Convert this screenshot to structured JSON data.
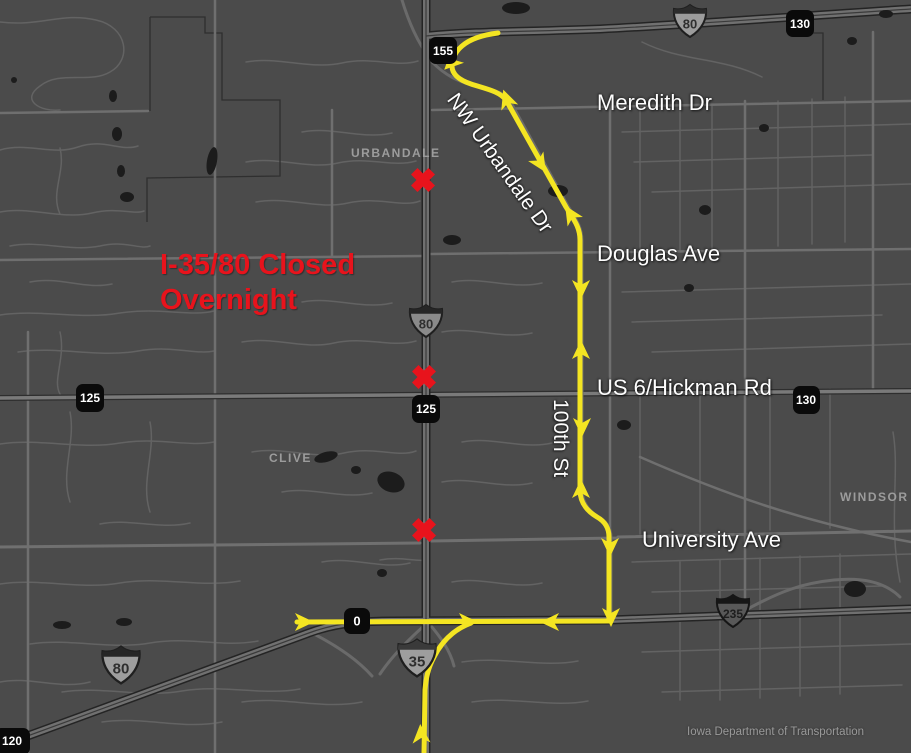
{
  "map": {
    "warning_text": "I-35/80 Closed Overnight",
    "street_labels": {
      "meredith": "Meredith Dr",
      "urbandale_dr": "NW Urbandale Dr",
      "douglas": "Douglas Ave",
      "hickman": "US 6/Hickman Rd",
      "street_100th": "100th St",
      "university": "University Ave"
    },
    "city_labels": {
      "urbandale": "URBANDALE",
      "clive": "CLIVE",
      "windsor_heights": "WINDSOR H"
    },
    "interstate_shields": {
      "i80_top": "80",
      "i80_mid": "80",
      "i80_southwest": "80",
      "i35": "35",
      "i235": "235"
    },
    "mile_markers": {
      "m155": "155",
      "m130_top": "130",
      "m125_left": "125",
      "m125_mid": "125",
      "m130_right": "130",
      "m0": "0",
      "m120": "120"
    },
    "closure_x_count": 3,
    "attribution": "Iowa Department of Transportation",
    "colors": {
      "detour_route": "#f4e522",
      "closure_red": "#e8131c",
      "background": "#4b4b4b"
    }
  }
}
